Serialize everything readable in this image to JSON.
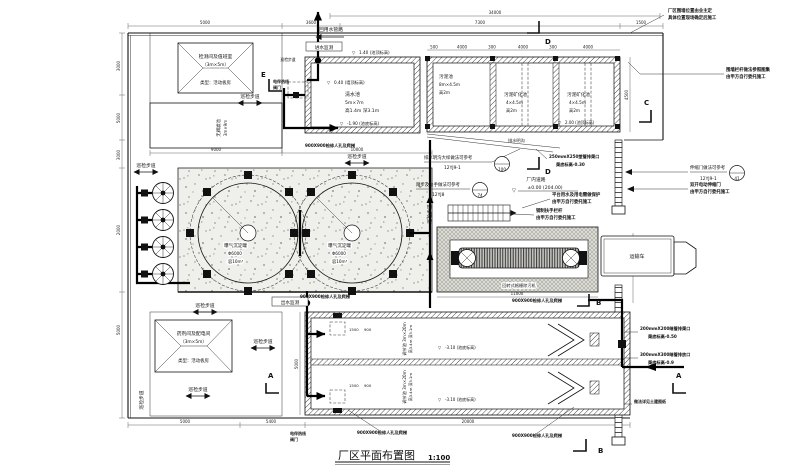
{
  "title": {
    "name": "厂区平面布置图",
    "scale": "1:100"
  },
  "buildings": {
    "monitor": {
      "l1": "检测间及值班室",
      "l2": "（3m×5m）",
      "l3": "类型：活动板房"
    },
    "chem": {
      "l1": "药剂间及配电间",
      "l2": "（3m×5m）",
      "l3": "类型：活动板房"
    },
    "filter": {
      "l1": "无阀滤池",
      "l2": "3m×9m"
    }
  },
  "tanks": {
    "clear": {
      "name": "清水池",
      "size": "5m×7m",
      "spec": "高1.4m 深3.1m",
      "top": "1.40 (池顶标高)",
      "wall_top": "0.40 (墙顶标高)",
      "bottom": "-1.90 (池底标高)"
    },
    "sludge": {
      "name": "污泥池",
      "size": "8m×4.5m",
      "h": "高2m"
    },
    "mineral": {
      "name": "污泥矿化池",
      "size": "4×4.5m",
      "h": "高2m"
    },
    "sludge_top": "2.00 (池顶标高)",
    "aer": {
      "name": "曝气沉淀罐",
      "size": "Φ6000",
      "vol": "容10m³"
    },
    "reg": {
      "l1": "调节池 3m×20m",
      "l2": "高3.4m 深3.1m",
      "bottom": "-3.10 (池底标高)"
    },
    "screen": "回转式格栅除污机"
  },
  "labels": {
    "walkway": "巡检步道",
    "reuse": "回用水管路",
    "in_mon": "进水监测",
    "out_mon": "出水监测",
    "road": "厂内道路",
    "road_lv": "±0.00 (204.00)",
    "truck": "运输车",
    "manhole": "900X900检修人孔及爬梯",
    "heat1": "电伴热线",
    "heat2": "阀门",
    "ditch": "排水明沟",
    "d250a": "250mmX250塑管排渠口",
    "d250b": "渠底标高-0.30",
    "d200a": "200mmX200暗管排渠口",
    "d200b": "渠底标高-0.50",
    "d300a": "300mmX300暗管排放口",
    "d300b": "渠底标高-0.9",
    "civil": "做法详见土建图纸"
  },
  "callouts": [
    {
      "text": "排水明沟大样做法可参考",
      "code": "12YJ9-1",
      "num": "100"
    },
    {
      "text": "踏步及扶手做法可参考",
      "code": "12YJ8",
      "num": "74"
    },
    {
      "text": "伸缩门做法可参考",
      "code": "12YJ9-1",
      "num": "41"
    }
  ],
  "notes": [
    {
      "l1": "厂区围墙位置由业主定",
      "l2": "具体位置现场确定后施工"
    },
    {
      "l1": "围墙栏杆做法参照图集",
      "l2": "由甲方自行委托施工"
    },
    {
      "l1": "双开电动伸缩门",
      "l2": "由甲方自行委托施工"
    },
    {
      "l1": "平台用水及用电需做保护",
      "l2": "由甲方自行委托施工"
    },
    {
      "l1": "钢制扶手栏杆",
      "l2": "由甲方自行委托施工"
    }
  ],
  "sections": {
    "a": "A",
    "b": "B",
    "c": "C",
    "d": "D",
    "e": "E"
  },
  "dims": {
    "d34000": "34000",
    "d5000": "5000",
    "d3600": "3600",
    "d7300": "7300",
    "d1500": "1500",
    "d9000": "9000",
    "d10000": "10000",
    "d11000": "11000",
    "d20000": "20000",
    "d5400": "5400",
    "d4500": "4500",
    "d3000": "3000",
    "d2000": "2000",
    "d500": "500",
    "d4000": "4000",
    "d300": "300",
    "d3500": "3500",
    "d900": "900"
  }
}
